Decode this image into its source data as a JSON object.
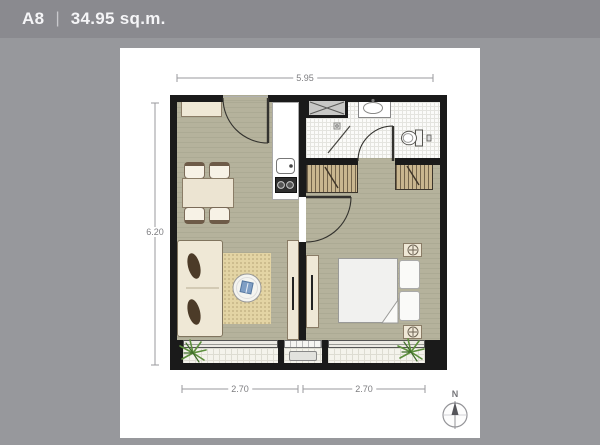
{
  "header": {
    "unit": "A8",
    "separator": "|",
    "area": "34.95 sq.m."
  },
  "dimensions": {
    "top_width": "5.95",
    "left_height": "6.20",
    "bottom_left": "2.70",
    "bottom_right": "2.70"
  },
  "compass": {
    "north_label": "N"
  },
  "icons": {
    "compass": "compass-north-icon",
    "plants": "plant-icon",
    "shaft_cross": "shaft-x-icon"
  },
  "colors": {
    "header_bg": "#8a8a8f",
    "page_bg": "#97989c",
    "card_bg": "#ffffff",
    "wall": "#1a1a1a",
    "unit_floor": "#b5b29c",
    "bathroom_floor": "#fbfbf9",
    "balcony_floor": "#f4f3ec",
    "furniture_cream": "#efe8d6",
    "wardrobe_tan": "#c9b68f",
    "rug_sand": "#e3d4a4",
    "accent_blue": "#7f9ec4",
    "plant_green": "#5d8f3d",
    "dimension_text": "#7d7d80"
  }
}
